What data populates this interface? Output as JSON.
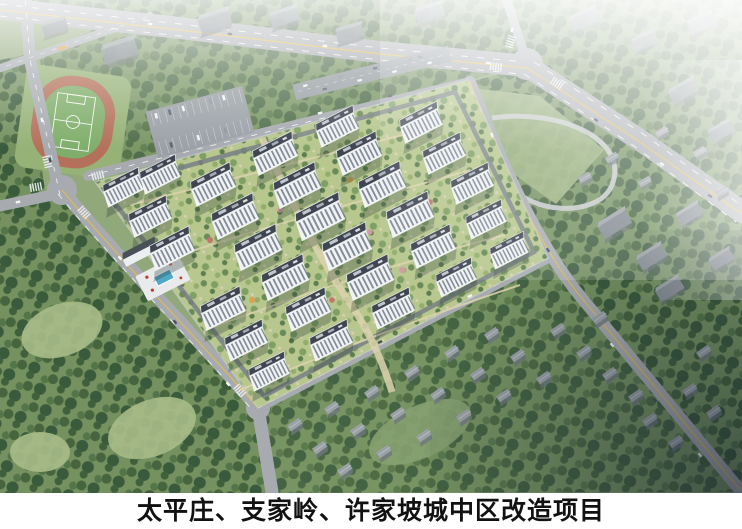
{
  "caption": {
    "text": "太平庄、支家岭、许家坡城中区改造项目"
  },
  "palette": {
    "caption_bg": "#ffffff",
    "caption_text": "#111111",
    "grass": "#90a87a",
    "lawn_light": "#a9bd8a",
    "forest_dark": "#42603e",
    "garden_bg": "#b7c78e",
    "road": "#a7abb0",
    "road_dark": "#787f86",
    "lane_white": "#f2f5f7",
    "lane_yellow": "#e2bb4e",
    "track_red": "#b4705a",
    "pitch_green": "#7fae6a",
    "building_face": "#f0f2f4",
    "building_roof": "#3f4551",
    "village_roof": "#9aa1a7",
    "city_block": "#7e868d",
    "pool_blue": "#4fa8c8",
    "path_tan": "#ddd3ae",
    "haze": "#ffffff",
    "vignette": "#16202e"
  }
}
